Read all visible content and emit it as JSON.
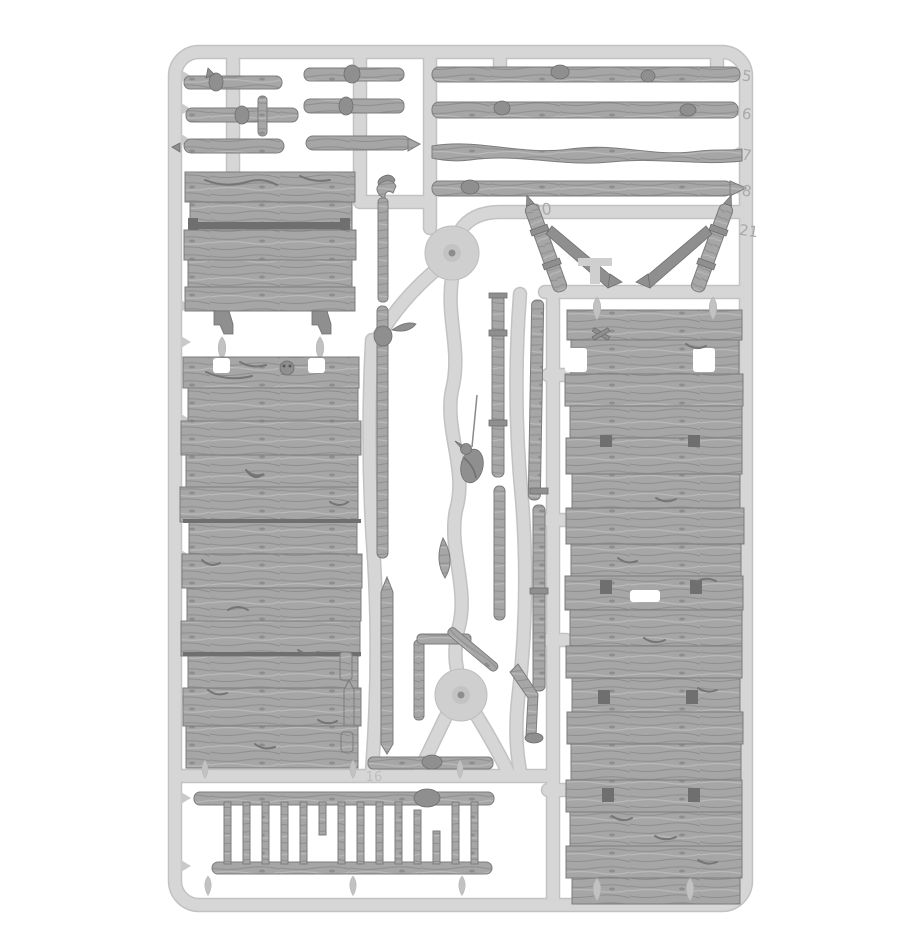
{
  "scene": {
    "description": "Grey plastic model sprue photographed on a white background: weathered wooden plank wall panels, branch sticks, poles, braces and ladders for tabletop terrain",
    "background_color": "#ffffff",
    "runner_color": "#d2d2d2",
    "part_color": "#a6a6a6",
    "separator_color": "#6f6f6f"
  },
  "markings": {
    "stick_5": "5",
    "stick_6": "6",
    "stick_7": "7",
    "stick_8": "8",
    "brace_left": "20",
    "brace_right": "21",
    "runner_16": "16",
    "bottom_17": "17"
  },
  "components": [
    "sprue-frame",
    "short-stick",
    "long-stick",
    "notice-board-panel",
    "plank-wall-left",
    "plank-wall-right",
    "diagonal-brace",
    "branch-pole",
    "hanging-crow",
    "leaf-sprig",
    "injection-hub",
    "ladder",
    "teardrop-gate"
  ]
}
